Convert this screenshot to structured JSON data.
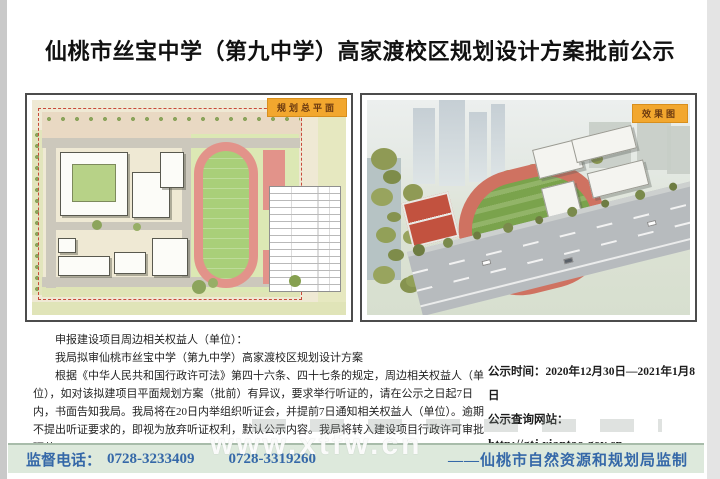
{
  "page": {
    "title": "仙桃市丝宝中学（第九中学）高家渡校区规划设计方案批前公示"
  },
  "panels": {
    "site_plan": {
      "badge": "规划总平面"
    },
    "rendering": {
      "badge": "效果图"
    }
  },
  "notice": {
    "line1": "申报建设项目周边相关权益人（单位）：",
    "line2": "我局拟审仙桃市丝宝中学（第九中学）高家渡校区规划设计方案",
    "body": "根据《中华人民共和国行政许可法》第四十六条、四十七条的规定，周边相关权益人（单位），如对该拟建项目平面规划方案（批前）有异议，要求举行听证的，请在公示之日起7日内，书面告知我局。我局将在20日内举组织听证会，并提前7日通知相关权益人（单位）。逾期不提出听证要求的，即视为放弃听证权利，默认公示内容。我局将转入建设项目行政许可审批环节。"
  },
  "publicity": {
    "time": "公示时间：2020年12月30日—2021年1月8日",
    "site_label": "公示查询网站：",
    "url": "http://gtj.xiantao.gov.cn"
  },
  "footer": {
    "phone_label": "监督电话：",
    "phone1": "0728-3233409",
    "phone2": "0728-3319260",
    "producer": "——仙桃市自然资源和规划局监制",
    "watermark": "www.xtfw.cn"
  },
  "colors": {
    "badge_bg": "#f2a72e",
    "badge_text": "#6b3a10",
    "footer_bg": "#dde9dc",
    "footer_text": "#3568a8",
    "track_red": "#cf7261",
    "field_green": "#7aa34c"
  }
}
